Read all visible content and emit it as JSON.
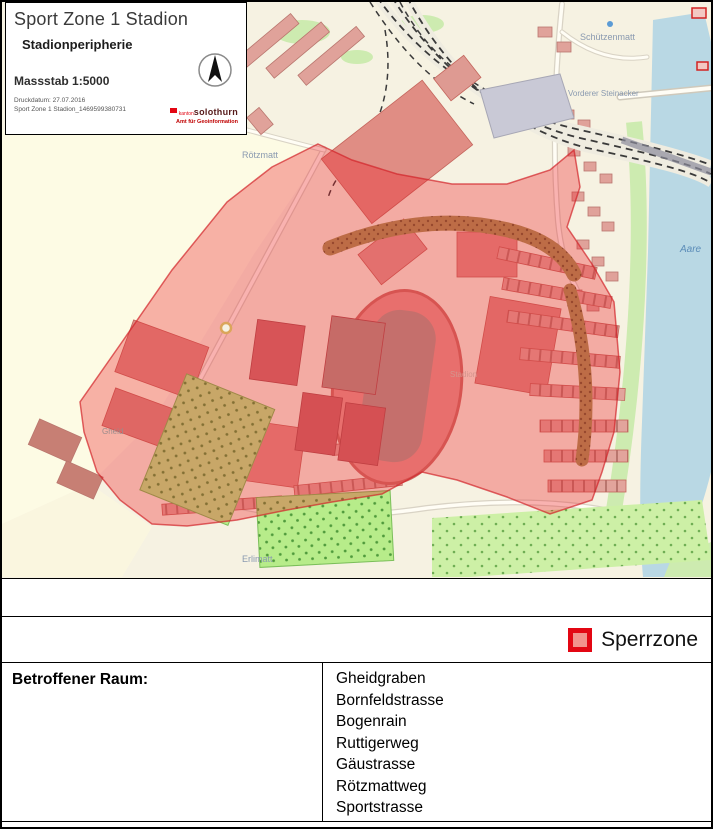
{
  "title_box": {
    "title": "Sport Zone 1 Stadion",
    "subtitle": "Stadionperipherie",
    "scale_label": "Massstab 1:5000",
    "print_date": "Druckdatum: 27.07.2016",
    "document_id": "Sport Zone 1 Stadion_1469599380731",
    "logo": {
      "kanton_prefix": "kanton",
      "kanton_name": "solothurn",
      "department": "Amt für Geoinformation"
    }
  },
  "map": {
    "labels": {
      "roetzmatt": "Rötzmatt",
      "schuetzenmatt": "Schützenmatt",
      "vorderer_steinacker": "Vorderer Steinacker",
      "aare": "Aare",
      "erlimatt": "Erlimatt",
      "gheid": "Gheid",
      "stadion": "Stadion"
    },
    "colors": {
      "background": "#f6f2e2",
      "fields": "#fdfbe4",
      "water": "#b9d8e4",
      "buildings": "#e0a29a",
      "restricted_overlay": "#ed1c24"
    }
  },
  "legend": {
    "sperrzone_label": "Sperrzone",
    "swatch_border_color": "#e30613",
    "swatch_fill_color": "#f2928c"
  },
  "affected_area": {
    "label": "Betroffener Raum:",
    "streets": [
      "Gheidgraben",
      "Bornfeldstrasse",
      "Bogenrain",
      "Ruttigerweg",
      "Gäustrasse",
      "Rötzmattweg",
      "Sportstrasse"
    ]
  }
}
